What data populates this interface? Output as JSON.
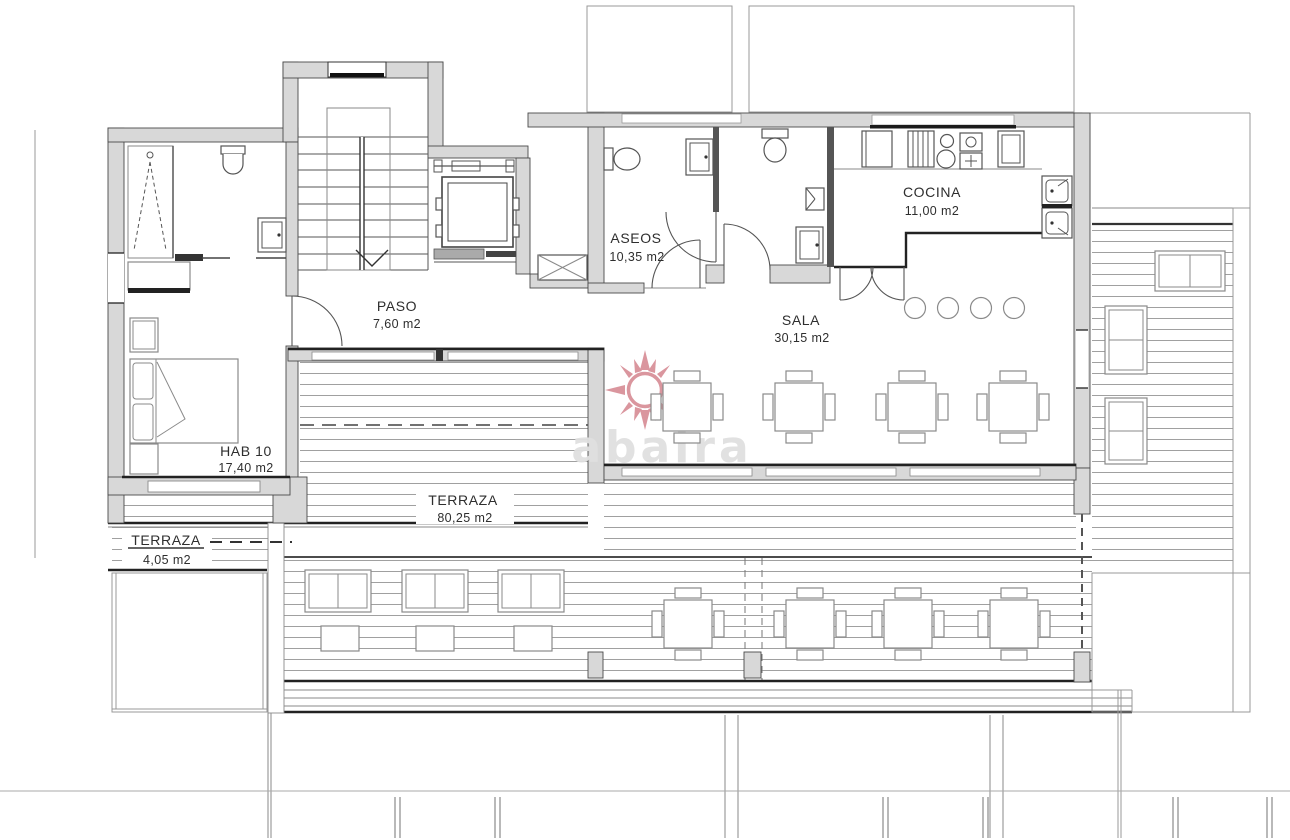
{
  "title": "Planta - vivienda con terraza",
  "watermark": {
    "text": "abaira"
  },
  "colors": {
    "wall-fill": "#d8d8d8",
    "wall-stroke": "#4a4a4a",
    "line": "#8a8a8a",
    "dark": "#222222",
    "label": "#2e2e2e",
    "wm-sun": "#d4848e",
    "wm-text": "#e0e0e0",
    "bg": "#ffffff"
  },
  "rooms": [
    {
      "name": "COCINA",
      "area": "11,00 m2"
    },
    {
      "name": "ASEOS",
      "area": "10,35 m2"
    },
    {
      "name": "SALA",
      "area": "30,15 m2"
    },
    {
      "name": "PASO",
      "area": "7,60 m2"
    },
    {
      "name": "HAB 10",
      "area": "17,40 m2"
    },
    {
      "name": "TERRAZA",
      "area": "80,25 m2"
    },
    {
      "name": "TERRAZA",
      "area": "4,05 m2"
    }
  ],
  "icons": [
    "stairs-icon",
    "elevator-icon",
    "shower-icon",
    "toilet-icon",
    "sink-icon",
    "bed-icon",
    "dining-table-icon",
    "sun-lounger-icon",
    "kitchen-counter-icon",
    "double-sink-icon",
    "door-swing-icon",
    "duct-icon",
    "bar-stool-icon",
    "sun-watermark-icon"
  ]
}
